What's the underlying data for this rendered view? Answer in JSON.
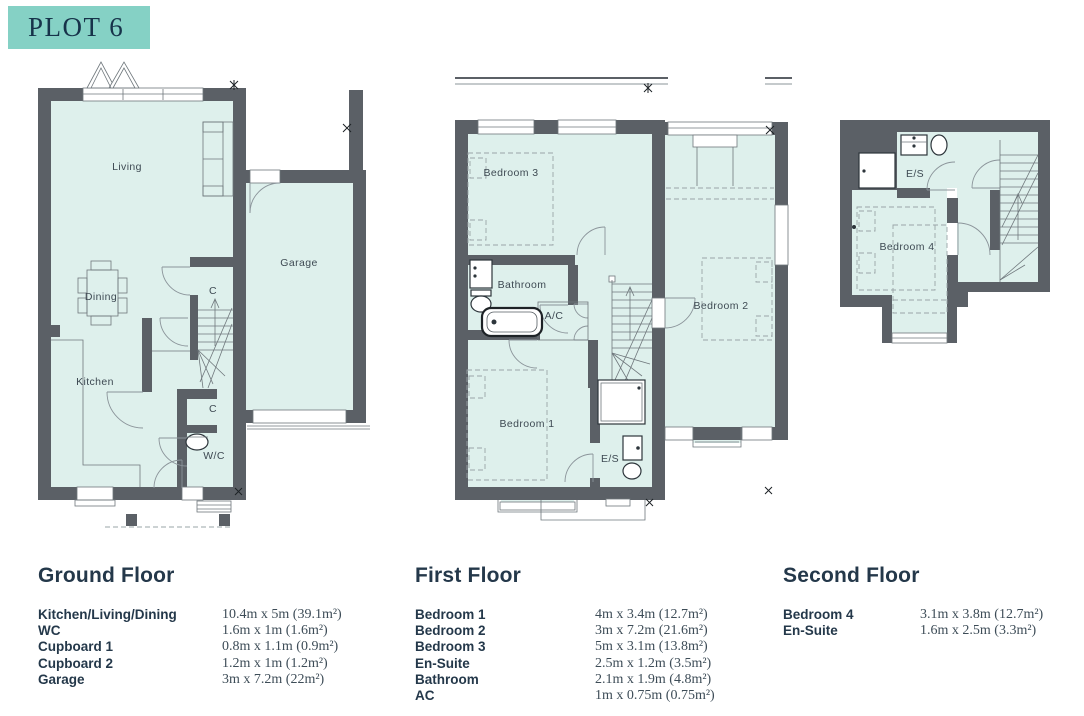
{
  "plot": {
    "title": "PLOT 6"
  },
  "colors": {
    "accent_teal": "#85d1c5",
    "navy": "#24384a",
    "wall_grey": "#5b6066",
    "room_fill": "#def0ec"
  },
  "floors": [
    {
      "title": "Ground Floor",
      "rooms": {
        "living": "Living",
        "dining": "Dining",
        "kitchen": "Kitchen",
        "c1": "C",
        "c2": "C",
        "wc": "W/C",
        "garage": "Garage"
      },
      "table": [
        {
          "label": "Kitchen/Living/Dining",
          "dims": "10.4m x 5m (39.1m²)"
        },
        {
          "label": "WC",
          "dims": "1.6m x 1m (1.6m²)"
        },
        {
          "label": "Cupboard 1",
          "dims": "0.8m x 1.1m (0.9m²)"
        },
        {
          "label": "Cupboard 2",
          "dims": "1.2m x 1m (1.2m²)"
        },
        {
          "label": "Garage",
          "dims": "3m x 7.2m (22m²)"
        }
      ]
    },
    {
      "title": "First Floor",
      "rooms": {
        "bedroom3": "Bedroom 3",
        "bathroom": "Bathroom",
        "ac": "A/C",
        "bedroom1": "Bedroom 1",
        "es": "E/S",
        "bedroom2": "Bedroom 2"
      },
      "table": [
        {
          "label": "Bedroom 1",
          "dims": "4m x 3.4m (12.7m²)"
        },
        {
          "label": "Bedroom 2",
          "dims": "3m x 7.2m (21.6m²)"
        },
        {
          "label": "Bedroom 3",
          "dims": "5m x 3.1m (13.8m²)"
        },
        {
          "label": "En-Suite",
          "dims": "2.5m x 1.2m (3.5m²)"
        },
        {
          "label": "Bathroom",
          "dims": "2.1m x 1.9m (4.8m²)"
        },
        {
          "label": "AC",
          "dims": "1m x 0.75m (0.75m²)"
        }
      ]
    },
    {
      "title": "Second Floor",
      "rooms": {
        "es": "E/S",
        "bedroom4": "Bedroom 4"
      },
      "table": [
        {
          "label": "Bedroom 4",
          "dims": "3.1m x 3.8m (12.7m²)"
        },
        {
          "label": "En-Suite",
          "dims": "1.6m x 2.5m (3.3m²)"
        }
      ]
    }
  ]
}
